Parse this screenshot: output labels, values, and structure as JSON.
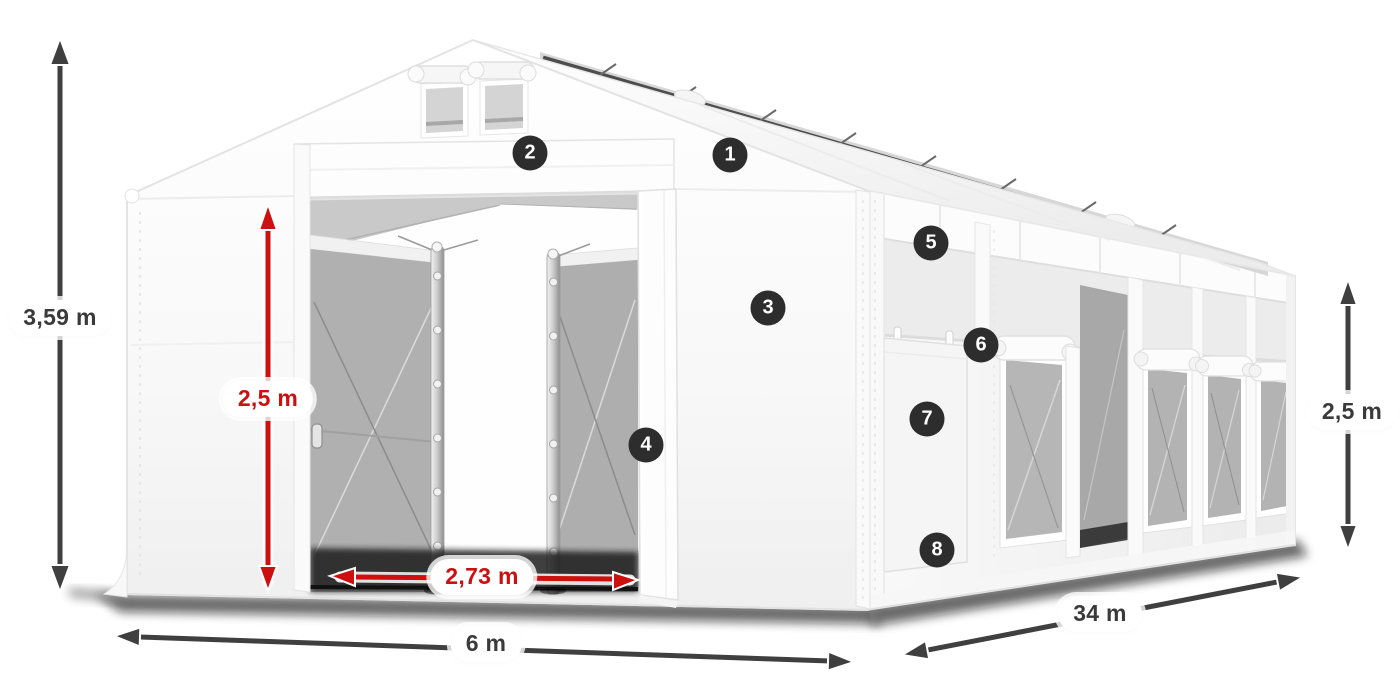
{
  "diagram": {
    "subject": "White PVC storage tent with open front sliding doors, dimension annotations and numbered feature callouts",
    "background": "#ffffff",
    "colors": {
      "dimension_primary": "#3f3f3f",
      "dimension_accent": "#cc1010",
      "badge_background": "#2d2d2d",
      "badge_text": "#ffffff",
      "label_background": "#ffffff",
      "tent_fabric": "#f7f7f7",
      "mesh_gray": "#aaaaaa"
    },
    "dimensions": {
      "total_height": {
        "label": "3,59 m",
        "style": "primary",
        "orientation": "vertical"
      },
      "door_height": {
        "label": "2,5 m",
        "style": "accent",
        "orientation": "vertical"
      },
      "door_width": {
        "label": "2,73 m",
        "style": "accent",
        "orientation": "horizontal"
      },
      "width": {
        "label": "6 m",
        "style": "primary",
        "orientation": "horizontal"
      },
      "length": {
        "label": "34 m",
        "style": "primary",
        "orientation": "diagonal"
      },
      "side_height": {
        "label": "2,5 m",
        "style": "primary",
        "orientation": "vertical"
      }
    },
    "callouts": [
      {
        "number": "1"
      },
      {
        "number": "2"
      },
      {
        "number": "3"
      },
      {
        "number": "4"
      },
      {
        "number": "5"
      },
      {
        "number": "6"
      },
      {
        "number": "7"
      },
      {
        "number": "8"
      }
    ]
  }
}
